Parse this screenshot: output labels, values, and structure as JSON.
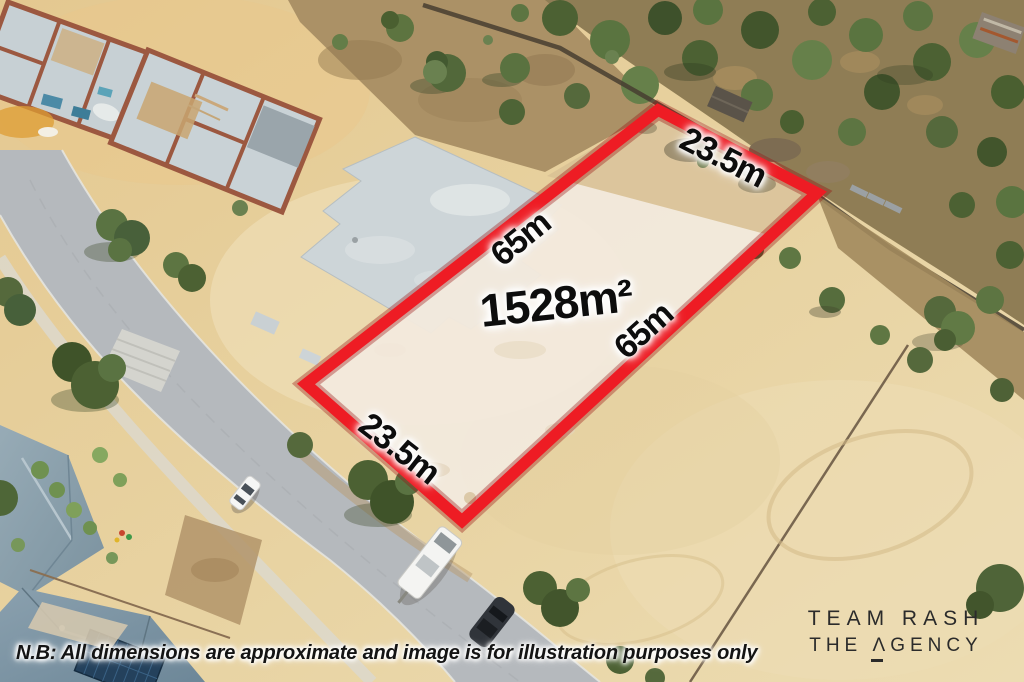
{
  "overlay": {
    "area_label": "1528m²",
    "dim_labels": {
      "top": "23.5m",
      "bottom": "23.5m",
      "side_upper": "65m",
      "side_lower": "65m"
    },
    "boundary_color": "#ee1c24",
    "label_color": "#0d0d0d",
    "label_halo_color": "#ffffff"
  },
  "disclaimer": {
    "text": "N.B: All dimensions are approximate and image is for illustration purposes only"
  },
  "brand": {
    "line1": "TEAM RASH",
    "line2": "THE ΛGENCY",
    "color": "#2b2b2b"
  },
  "scene_colors": {
    "sand": "#e6cd98",
    "cleared_lot": "#f2e9dd",
    "road": "#b5b9bd",
    "bushland": "#55693c",
    "roof": "#7d96a6",
    "concrete_slab": "#cdd5d8",
    "brick": "#9c5840"
  }
}
